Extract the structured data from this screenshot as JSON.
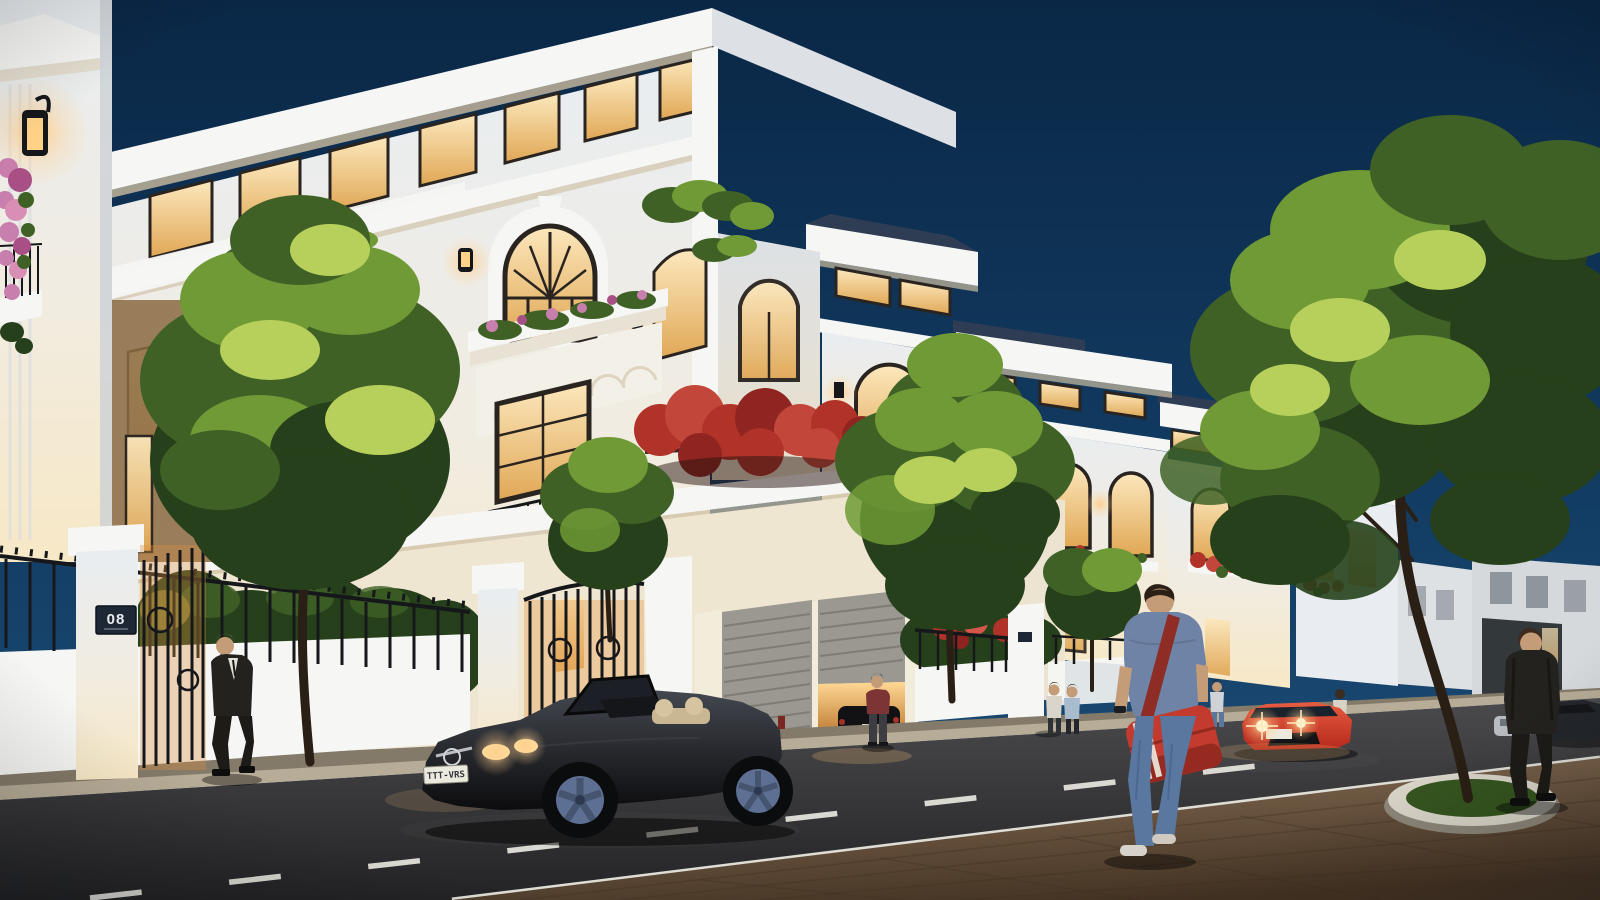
{
  "scene": {
    "type": "3d-architectural-render",
    "time_of_day": "dusk",
    "description": "Night-time exterior rendering of a row of white neoclassical villas with warm-lit windows along a street; a black convertible is parked at the curb, a red sports car with headlights on sits further down, pedestrians walk on the street and paver sidewalk, green street trees are uplit"
  },
  "labels": {
    "house_number_plaque": "08",
    "car_license_plate": "TTT-VRS"
  },
  "objects": {
    "villas": {
      "count": 5,
      "style": "white 3-4 storey neoclassical villas, flat overhanging roof slabs, clerestory window bands, arched windows with black frames, wrought-iron juliet balconies, flower boxes, wall lanterns, grey roller garage doors, white fences with black iron railings"
    },
    "vehicles": [
      {
        "name": "black-convertible",
        "detail": "dark roadster with top down, beige seats, lit headlights, grey five-spoke wheels, front license plate"
      },
      {
        "name": "red-sports-car",
        "detail": "red coupe facing viewer with glowing headlights and white plate"
      },
      {
        "name": "garage-car",
        "detail": "dark car inside warm-lit open garage"
      },
      {
        "name": "distant-parked-cars",
        "detail": "light grey car and dark car near right edge"
      }
    ],
    "pedestrians": [
      {
        "name": "suit-man-left",
        "detail": "dark suit, white shirt, walking past iron fence"
      },
      {
        "name": "red-shirt-man",
        "detail": "maroon t-shirt standing by open garage"
      },
      {
        "name": "couple-by-fence",
        "detail": "two figures standing near villa fence"
      },
      {
        "name": "figure-at-door",
        "detail": "small figure near villa entrance"
      },
      {
        "name": "figure-behind-red-car",
        "detail": "light-top figure behind red car"
      },
      {
        "name": "red-bag-walker",
        "detail": "man with blue t-shirt, jeans, red messenger bag with white stripes crossing the street"
      },
      {
        "name": "suit-man-right",
        "detail": "dark suit walking away on paver sidewalk"
      }
    ],
    "vegetation": {
      "street_trees": 4,
      "large_right_tree_in_round_planter": true,
      "bougainvillea_pergola": "red flowering canopy between first and second villa",
      "balcony_flower_boxes": "pink and red blooms"
    },
    "road": {
      "markings": [
        "dashed white center line",
        "solid white edge line"
      ],
      "sidewalk": "brown paver sidewalk bottom right with round white tree planter"
    }
  },
  "palette": {
    "sky_top": "#0a2746",
    "sky_mid": "#123c63",
    "sky_horizon": "#1e4f78",
    "facade_cool": "#e9edf1",
    "facade": "#f1ece0",
    "facade_warm": "#f7e8c6",
    "facade_bright": "#f6f6f4",
    "facade_shade": "#dde1e6",
    "facade_shade_warm": "#e9dfc9",
    "cornice_shadow": "#cdbda0",
    "window_frame": "#2a2420",
    "window_glow": "#fce8bd",
    "window_glow_deep": "#e0a755",
    "roof_slate": "#2e3d54",
    "iron": "#15171a",
    "tree_dark": "#26401b",
    "tree_mid": "#3f6126",
    "tree_lit": "#6f9a35",
    "tree_highlight": "#b7d05b",
    "flower_red": "#b03228",
    "flower_pink": "#c97fae",
    "glow_warm": "#ffcf8e",
    "road_light": "#4b4b4e",
    "road_dark": "#232325",
    "road_line": "#e8e7e0",
    "curb": "#b7ac97",
    "walk_strip": "#847a69",
    "paver_light": "#8a7158",
    "paver_dark": "#443323",
    "car_black": "#0c0c0e",
    "car_red": "#b3281c",
    "wheel_grey": "#5d6f92",
    "headlight": "#ffdf9e",
    "plate_white": "#ece9df",
    "suit_dark": "#23221e",
    "skin": "#c59c78",
    "denim": "#5a77a0",
    "tshirt_blue": "#6f83a6",
    "bag_red": "#c23b2e",
    "shirt_red": "#7c3434",
    "grass_green": "#35551f",
    "trunk_brown": "#2a1f14"
  }
}
